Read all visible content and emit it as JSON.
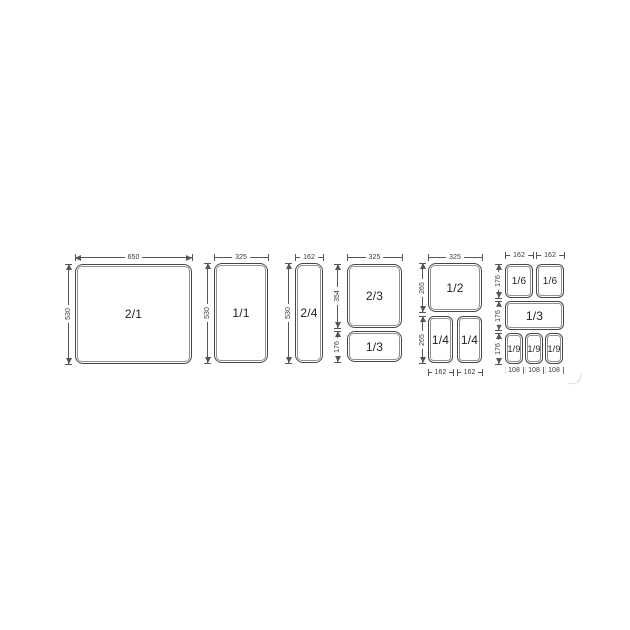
{
  "diagram": {
    "groups": [
      {
        "id": "gn-2-1",
        "top_dims": [
          "650"
        ],
        "left_dims": [
          "530"
        ],
        "boxes": [
          {
            "label": "2/1"
          }
        ]
      },
      {
        "id": "gn-1-1",
        "top_dims": [
          "325"
        ],
        "left_dims": [
          "530"
        ],
        "boxes": [
          {
            "label": "1/1"
          }
        ]
      },
      {
        "id": "gn-2-4",
        "top_dims": [
          "162"
        ],
        "left_dims": [
          "530"
        ],
        "boxes": [
          {
            "label": "2/4"
          }
        ]
      },
      {
        "id": "gn-2-3-1-3",
        "top_dims": [
          "325"
        ],
        "left_dims": [
          "354",
          "176"
        ],
        "boxes": [
          {
            "label": "2/3"
          },
          {
            "label": "1/3"
          }
        ]
      },
      {
        "id": "gn-1-2-1-4",
        "top_dims": [
          "325"
        ],
        "left_dims": [
          "265",
          "265"
        ],
        "bottom_dims": [
          "162",
          "162"
        ],
        "boxes": [
          {
            "label": "1/2"
          },
          {
            "label": "1/4"
          },
          {
            "label": "1/4"
          }
        ]
      },
      {
        "id": "gn-1-6-1-3-1-9",
        "top_dims": [
          "162",
          "162"
        ],
        "left_dims": [
          "176",
          "176",
          "176"
        ],
        "bottom_dims": [
          "108",
          "108",
          "108"
        ],
        "boxes": [
          {
            "label": "1/6"
          },
          {
            "label": "1/6"
          },
          {
            "label": "1/3"
          },
          {
            "label": "1/9"
          },
          {
            "label": "1/9"
          },
          {
            "label": "1/9"
          }
        ]
      }
    ]
  }
}
